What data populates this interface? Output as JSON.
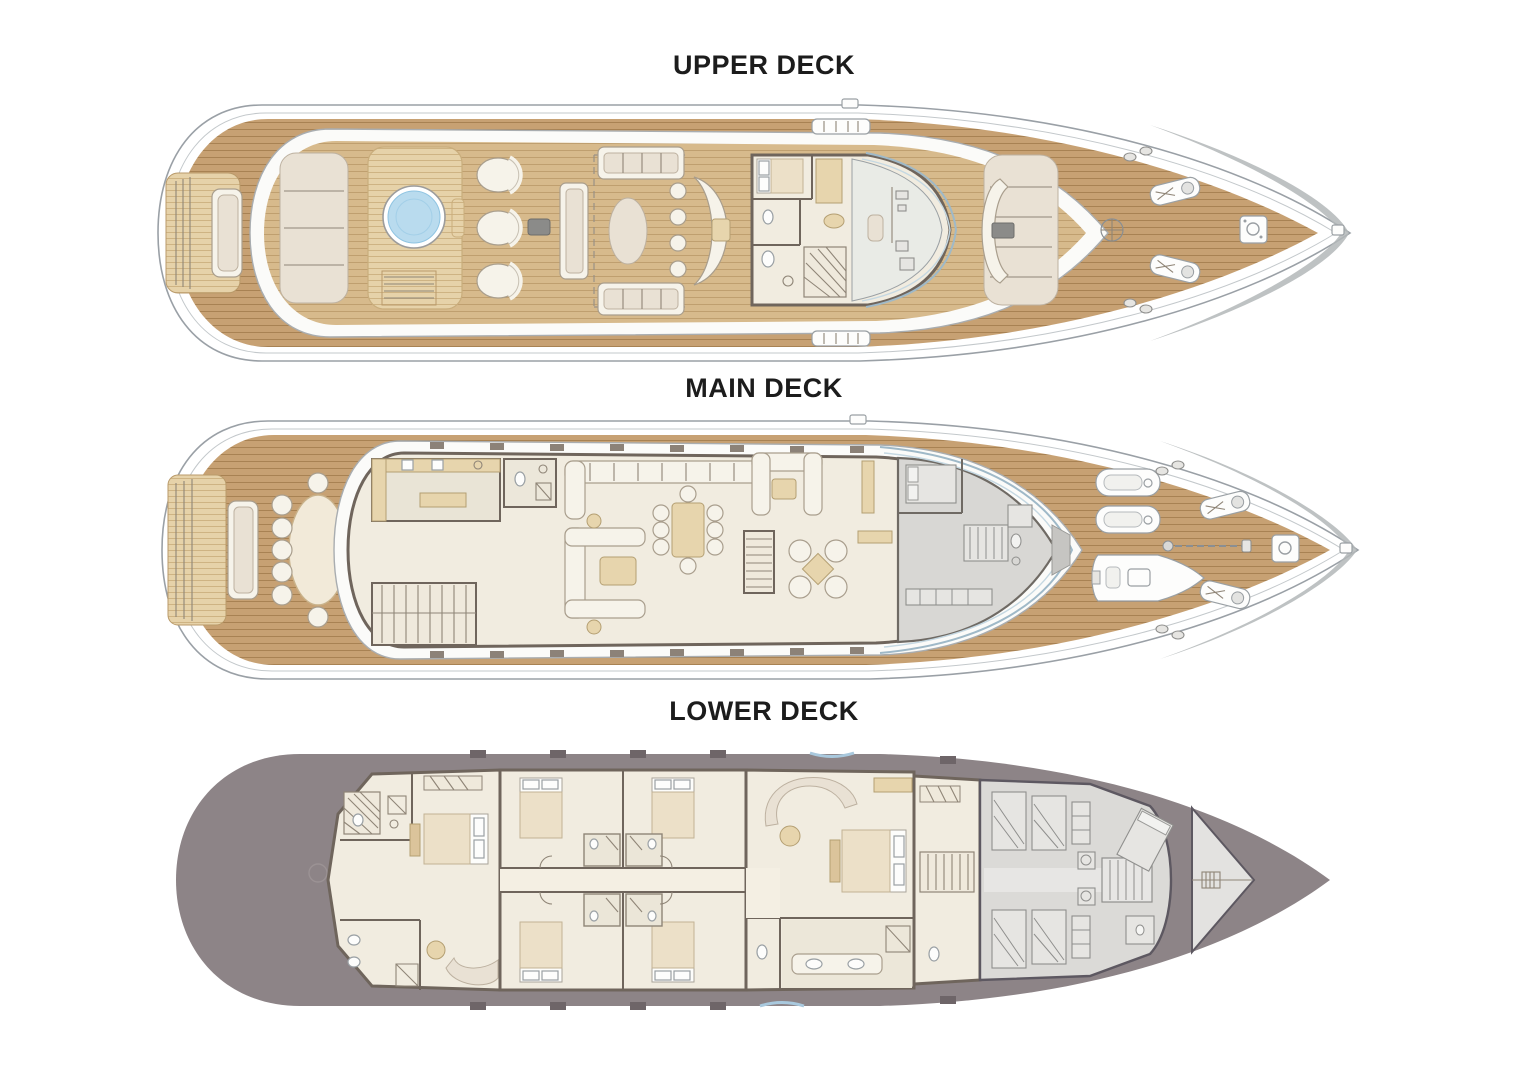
{
  "document": {
    "type": "yacht-general-arrangement-plan",
    "background": "#ffffff"
  },
  "decks": [
    {
      "id": "upper",
      "title": "UPPER DECK",
      "features": [
        "stern-platform",
        "aft-bench-sofa",
        "sun-pad",
        "jacuzzi-spa-pool",
        "spa-deck-stairs",
        "round-loungers",
        "lounge-sofas",
        "oval-coffee-table",
        "curved-wet-bar-with-stools",
        "captains-cabin",
        "day-head",
        "internal-staircase",
        "wheelhouse-with-curved-windshield",
        "bridge-wing-stations",
        "bow-lounge-seating",
        "foredeck",
        "anchor-windlasses",
        "mooring-capstan",
        "bow-cleats"
      ]
    },
    {
      "id": "main",
      "title": "MAIN DECK",
      "features": [
        "swim-platform",
        "aft-deck-sofa",
        "alfresco-dining-table-12-chairs",
        "galley",
        "day-head",
        "staircase-down",
        "main-salon-corner-sofa",
        "salon-c-sofa",
        "coffee-table",
        "formal-dining-table-8-chairs",
        "staircase-up",
        "u-shaped-lounge-sofa",
        "armchair-cluster-with-table",
        "crew-and-captain-area-shaded",
        "windshield",
        "foredeck",
        "jet-skis",
        "tender-boat",
        "crane",
        "anchor-windlasses",
        "mooring-capstan"
      ]
    },
    {
      "id": "lower",
      "title": "LOWER DECK",
      "features": [
        "engine-room",
        "vip-suite-with-ensuite",
        "vip-staircase",
        "guest-cabin-1",
        "guest-cabin-2",
        "guest-cabin-3",
        "guest-cabin-4",
        "guest-corridor",
        "master-suite",
        "master-curved-sofa",
        "master-bathroom-twin-sinks",
        "stair-lobby",
        "crew-bunk-cabins",
        "crew-corridor-stairs",
        "laundry",
        "captains-quarters",
        "forepeak-locker"
      ]
    }
  ],
  "colors": {
    "teak_light": "#d7ba8c",
    "teak_dark": "#c7a173",
    "platform_wood": "#e6d2a9",
    "furniture_white": "#f6f3ea",
    "cushion_cream": "#e9e1d4",
    "wood_furniture": "#e7d5ad",
    "interior_floor": "#f0ebdf",
    "wall": "#6f655c",
    "jacuzzi_water": "#b9dbee",
    "glass": "#9fb9c8",
    "lower_hull": "#8d8487",
    "crew_gray": "#dbdad7",
    "shaded_area_gray": "#d8d7d4",
    "title_text": "#1c1c1c"
  }
}
